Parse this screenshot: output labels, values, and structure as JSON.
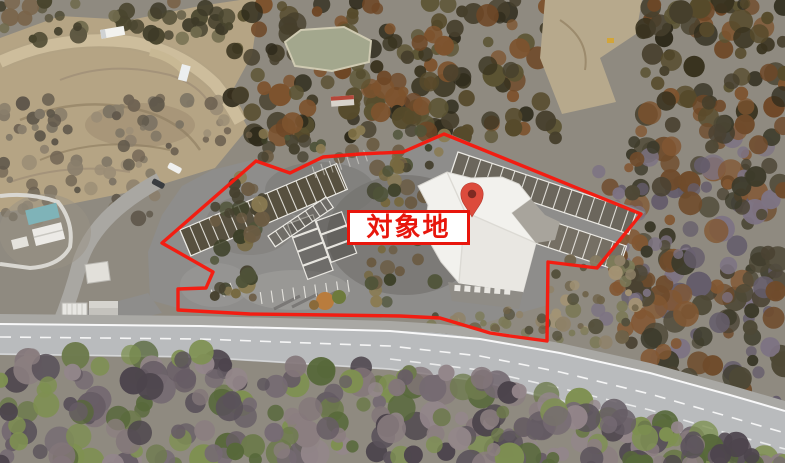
{
  "annotation": {
    "label": "対象地",
    "boundary_points": "162,243 256,161 290,173 323,157 360,154 403,152 444,134 641,214 597,268 548,262 547,341 510,336 490,333 440,318 400,316 330,315 250,314 178,310 178,289 206,288 213,272",
    "pin_transform": "translate(472,217) scale(0.92)",
    "colors": {
      "boundary": "#f61a0e",
      "label_text": "#e8160c",
      "label_border": "#e8160c",
      "label_bg": "#ffffff",
      "pin": "#dc4b3c",
      "pin_dot": "#7e2a22"
    }
  },
  "scene": {
    "type": "oblique-aerial-photograph",
    "visible_features": [
      "excavated-hillside-nw",
      "pond",
      "conifer-forest",
      "asphalt-parking-lot",
      "white-roof-building",
      "two-lane-road",
      "bare-deciduous-forest"
    ]
  }
}
